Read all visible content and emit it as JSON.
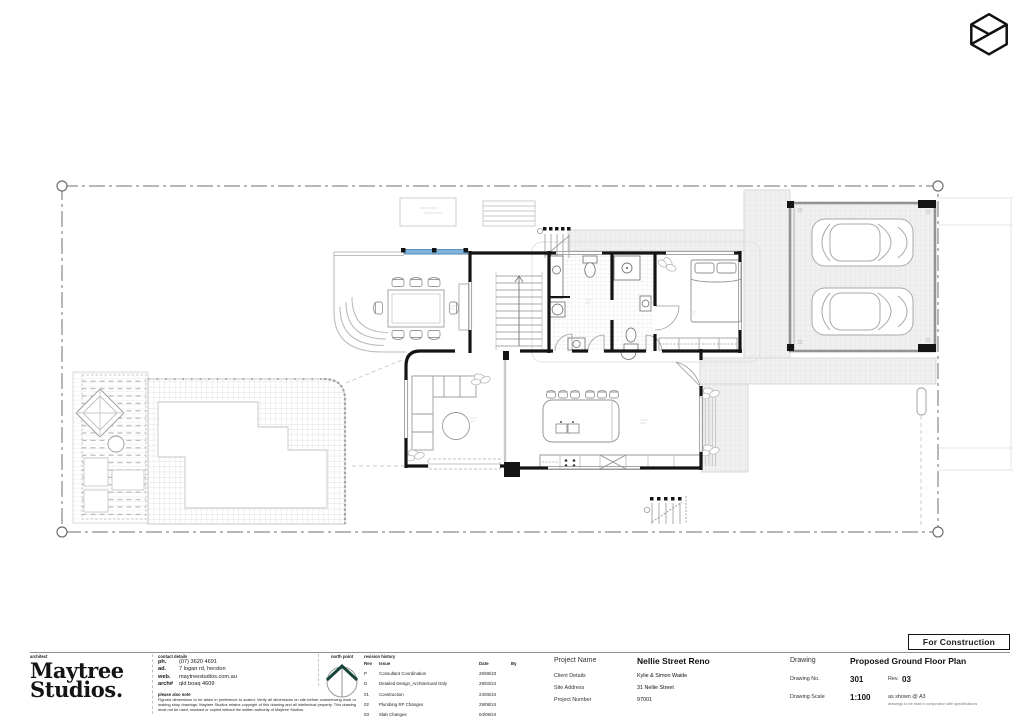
{
  "colors": {
    "glazing_blue": "#7FB3DC",
    "north_point_green": "#17453B",
    "wall_black": "#141414"
  },
  "brand": {
    "mark": "cube-icon"
  },
  "title_block": {
    "architect_label": "architect",
    "studio_line1": "Maytree",
    "studio_line2": "Studios.",
    "contact": {
      "heading": "contact details",
      "phone_label": "ph.",
      "phone": "(07) 3620 4691",
      "address_label": "ad.",
      "address": "7 logan rd, herston",
      "web_label": "web.",
      "web": "maytreestudios.com.au",
      "registration_label": "arch#",
      "registration": "qld boaq 4609",
      "notes_heading": "please also note",
      "notes": "Figured dimensions to be taken in preference to scaled. Verify all dimensions on site before commencing work or making shop drawings. Maytree Studios retains copyright of this drawing and all intellectual property. This drawing must not be used, retained or copied without the written authority of Maytree Studios."
    },
    "north_point_label": "north point",
    "revision_history": {
      "heading": "revision history",
      "headers": {
        "rev": "Rev",
        "issue": "Issue",
        "date": "Date",
        "by": "By"
      },
      "rows": [
        {
          "rev": "P",
          "issue": "Consultant Coordination",
          "date": "29/08/23",
          "by": ""
        },
        {
          "rev": "D",
          "issue": "Detailed Design_Architectural Only",
          "date": "29/03/24",
          "by": ""
        },
        {
          "rev": "01",
          "issue": "Construction",
          "date": "24/05/24",
          "by": ""
        },
        {
          "rev": "02",
          "issue": "Plumbing RF Changes",
          "date": "29/08/24",
          "by": ""
        },
        {
          "rev": "03",
          "issue": "Slab Changes",
          "date": "04/09/24",
          "by": ""
        }
      ]
    },
    "project": {
      "name_label": "Project Name",
      "name": "Nellie Street Reno",
      "client_label": "Client Details",
      "client": "Kylie & Simon Waide",
      "address_label": "Site Address",
      "address": "31 Nellie Street",
      "number_label": "Project Number",
      "number": "97001"
    },
    "drawing": {
      "drawing_label": "Drawing",
      "title": "Proposed Ground Floor Plan",
      "no_label": "Drawing No.",
      "no": "301",
      "rev_label": "Rev.",
      "rev": "03",
      "scale_label": "Drawing Scale",
      "scale": "1:100",
      "scale_note": "as shown @ A3",
      "fine_print": "drawings to be read in conjunction with specifications"
    },
    "stamp": "For Construction"
  }
}
